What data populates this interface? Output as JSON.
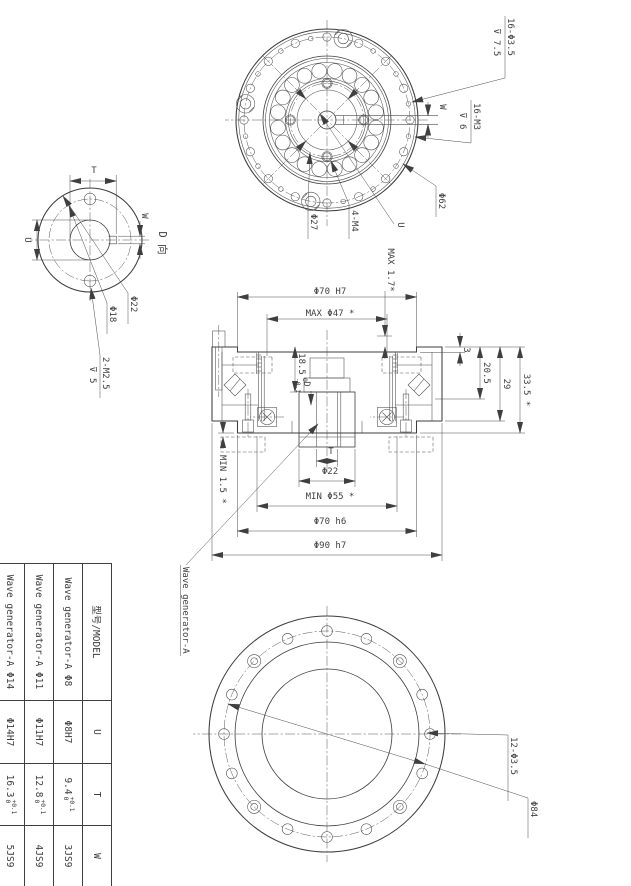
{
  "front_view": {
    "note_holes": "16-Φ3.5",
    "note_holes_depth": "⊽ 7.5",
    "note_tap": "16-M3",
    "note_tap_depth": "⊽ 6",
    "dim_w": "W",
    "dim_u": "U",
    "label_bolt_circle": "Φ62",
    "label_tap4": "4-M4",
    "label_inner_circle": "Φ27"
  },
  "d_view": {
    "title": "D 向",
    "dim_t": "T",
    "dim_w": "W",
    "dim_u": "U",
    "label_od": "Φ22",
    "label_bolt_circle": "Φ18",
    "note_tap": "2-M2.5",
    "note_tap_depth": "⊽ 5"
  },
  "section_view": {
    "dim_recess": "Φ70 H7",
    "dim_max47": "MAX Φ47 *",
    "dim_max17": "MAX 1.7*",
    "dim_3": "3",
    "dim_205": "20.5",
    "dim_29": "29",
    "dim_335": "33.5 *",
    "dim_185": "18.5",
    "dim_185_up": "0",
    "dim_185_dn": "-0.1",
    "view_label": "D",
    "dim_t": "T",
    "dim_22": "Φ22",
    "dim_min55": "MIN Φ55 *",
    "dim_70h6": "Φ70 h6",
    "dim_90h7": "Φ90 h7",
    "dim_min15": "MIN 1.5 *",
    "callout": "Wave generator-A"
  },
  "back_view": {
    "note_holes": "12-Φ3.5",
    "label_bolt_circle": "Φ84"
  },
  "table": {
    "headers": {
      "model": "型号/MODEL",
      "u": "U",
      "t": "T",
      "w": "W"
    },
    "rows": [
      {
        "model": "Wave generator-A Φ8",
        "u": "Φ8H7",
        "t": "9.4",
        "t_up": "+0.1",
        "t_dn": "0",
        "w": "3JS9"
      },
      {
        "model": "Wave generator-A Φ11",
        "u": "Φ11H7",
        "t": "12.8",
        "t_up": "+0.1",
        "t_dn": "0",
        "w": "4JS9"
      },
      {
        "model": "Wave generator-A Φ14",
        "u": "Φ14H7",
        "t": "16.3",
        "t_up": "+0.1",
        "t_dn": "0",
        "w": "5JS9"
      }
    ]
  },
  "colors": {
    "line": "#3f3f3f",
    "background": "#ffffff"
  }
}
